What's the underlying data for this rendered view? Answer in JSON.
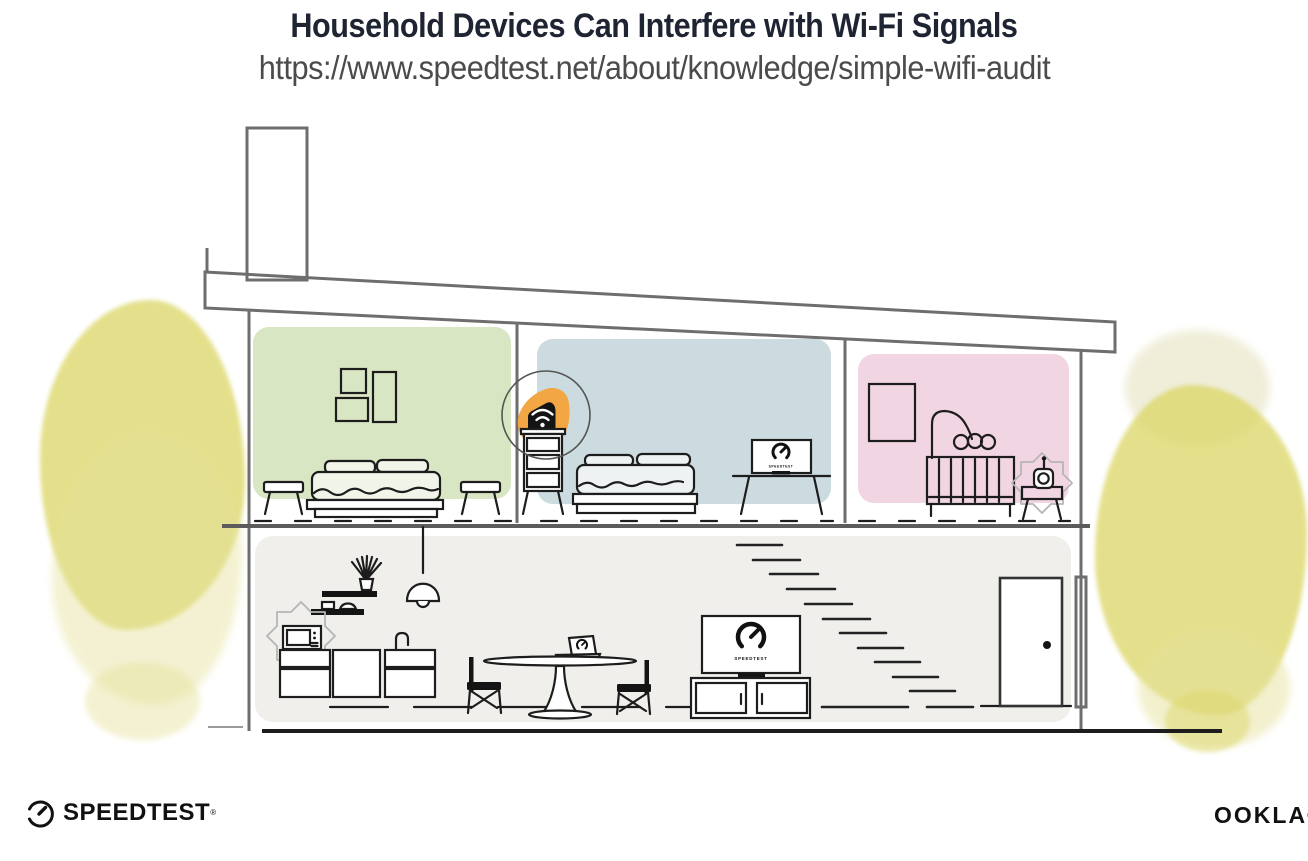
{
  "header": {
    "title": "Household Devices Can Interfere with Wi-Fi Signals",
    "url": "https://www.speedtest.net/about/knowledge/simple-wifi-audit"
  },
  "illustration": {
    "bedroom_tv_caption": "SPEEDTEST",
    "living_tv_caption": "SPEEDTEST",
    "colors": {
      "master_bedroom_green": "#d9e6c4",
      "kids_bedroom_blue": "#ccdbdf",
      "nursery_pink": "#f2d5e3",
      "ground_floor_gray": "#f0efec",
      "router_highlight_orange": "#f2a644",
      "foliage_yellow_green": "#dcd76a"
    }
  },
  "footer": {
    "speedtest_wordmark": "SPEEDTEST",
    "speedtest_trademark": "®",
    "ookla_wordmark": "OOKLA",
    "ookla_trademark": "®"
  }
}
